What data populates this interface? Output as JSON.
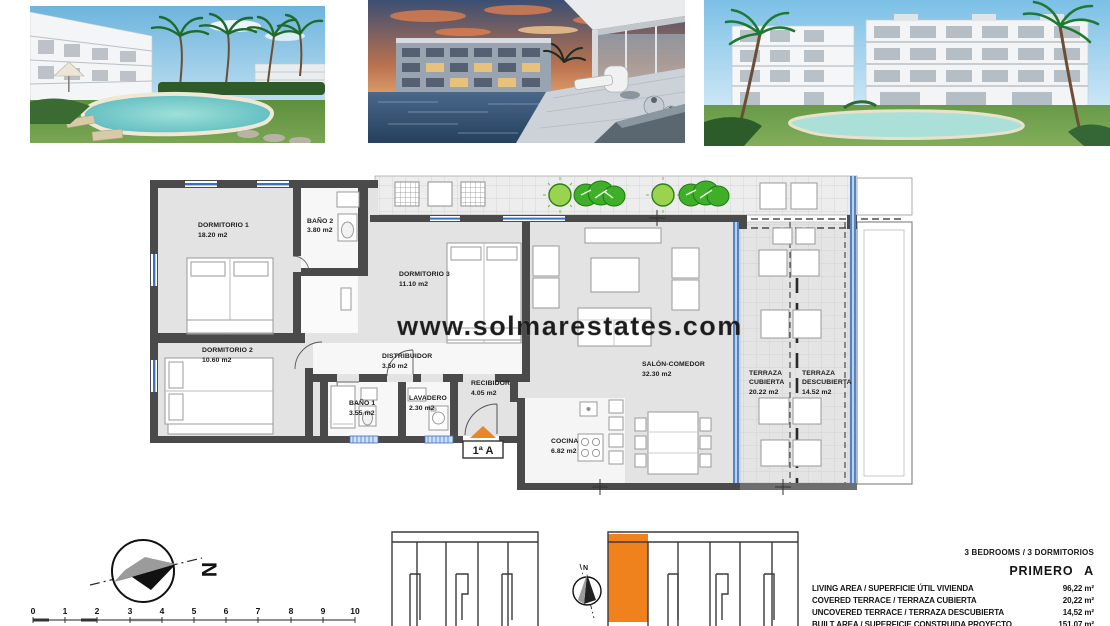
{
  "watermark": "www.solmarestates.com",
  "photos": [
    {
      "name": "pool-garden-day-render"
    },
    {
      "name": "terrace-pool-dusk-render"
    },
    {
      "name": "buildings-lawn-pool-render"
    }
  ],
  "floorplan": {
    "unit_label": "1ª A",
    "rooms": {
      "dormitorio1": {
        "name": "DORMITORIO 1",
        "area": "18.20 m2"
      },
      "bano2": {
        "name": "BAÑO 2",
        "area": "3.80 m2"
      },
      "dormitorio3": {
        "name": "DORMITORIO 3",
        "area": "11.10 m2"
      },
      "dormitorio2": {
        "name": "DORMITORIO 2",
        "area": "10.60 m2"
      },
      "distribuidor": {
        "name": "DISTRIBUIDOR",
        "area": "3.50 m2"
      },
      "bano1": {
        "name": "BAÑO 1",
        "area": "3.55 m2"
      },
      "lavadero": {
        "name": "LAVADERO",
        "area": "2.30 m2"
      },
      "recibidor": {
        "name": "RECIBIDOR",
        "area": "4.05 m2"
      },
      "salon": {
        "name": "SALÓN-COMEDOR",
        "area": "32.30 m2"
      },
      "cocina": {
        "name": "COCINA",
        "area": "6.82 m2"
      },
      "terraza_cubierta": {
        "line1": "TERRAZA",
        "line2": "CUBIERTA",
        "area": "20.22 m2"
      },
      "terraza_descubierta": {
        "line1": "TERRAZA",
        "line2": "DESCUBIERTA",
        "area": "14.52 m2"
      }
    }
  },
  "compass": {
    "north_label": "N"
  },
  "keyplan": {
    "north_label": "N",
    "highlight_color": "#F0821E"
  },
  "scale_bar": {
    "ticks": [
      "0",
      "1",
      "2",
      "3",
      "4",
      "5",
      "6",
      "7",
      "8",
      "9",
      "10"
    ]
  },
  "summary": {
    "bedrooms_line": "3 BEDROOMS / 3 DORMITORIOS",
    "unit_title": "PRIMERO A",
    "rows": [
      {
        "label": "LIVING AREA / SUPERFICIE ÚTIL VIVIENDA",
        "value": "96,22 m²"
      },
      {
        "label": "COVERED TERRACE / TERRAZA CUBIERTA",
        "value": "20,22 m²"
      },
      {
        "label": "UNCOVERED TERRACE / TERRAZA DESCUBIERTA",
        "value": "14,52 m²"
      },
      {
        "label": "BUILT AREA / SUPERFICIE CONSTRUIDA PROYECTO",
        "value": "151,07 m²"
      }
    ]
  }
}
